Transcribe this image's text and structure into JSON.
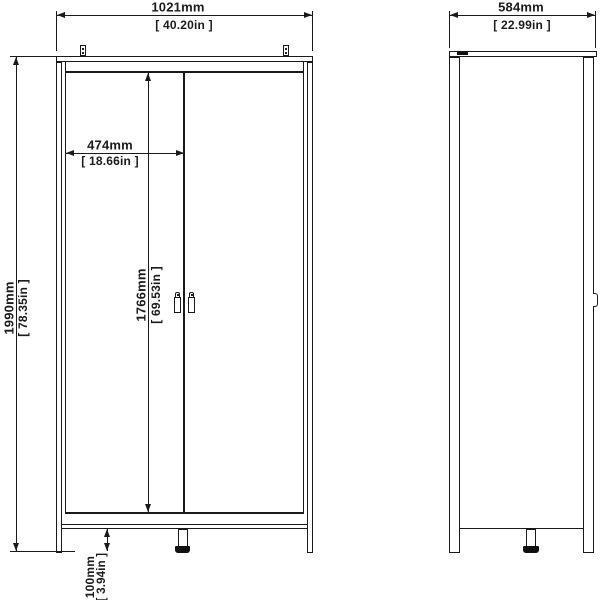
{
  "front_view": {
    "dim_overall_width": {
      "mm": "1021mm",
      "inches": "[ 40.20in ]"
    },
    "dim_overall_height": {
      "mm": "1990mm",
      "inches": "[ 78.35in ]"
    },
    "dim_door_width": {
      "mm": "474mm",
      "inches": "[ 18.66in ]"
    },
    "dim_door_height": {
      "mm": "1766mm",
      "inches": "[ 69.53in ]"
    },
    "dim_foot_height": {
      "mm": "100mm",
      "inches": "[ 3.94in ]"
    }
  },
  "side_view": {
    "dim_overall_depth": {
      "mm": "584mm",
      "inches": "[ 22.99in ]"
    }
  },
  "colors": {
    "line": "#1a1a1a",
    "background": "#ffffff",
    "foot_base": "#111111"
  }
}
